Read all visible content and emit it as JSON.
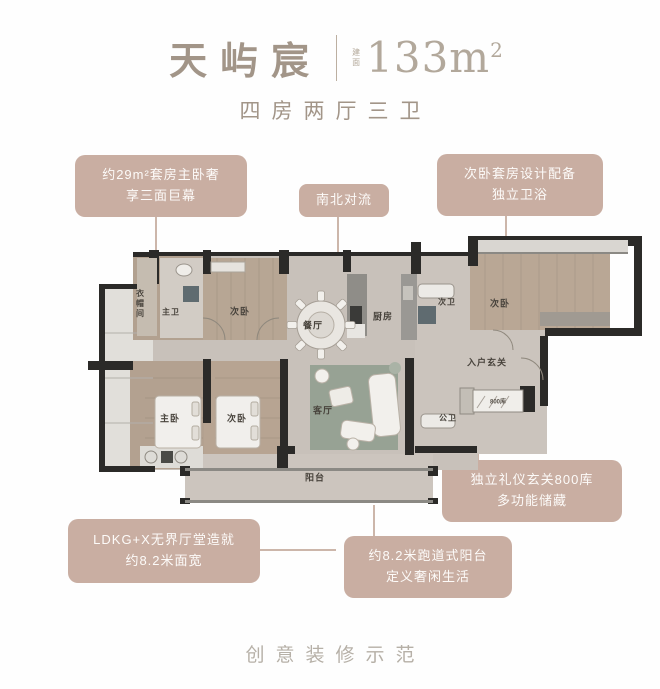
{
  "header": {
    "title": "天屿宸",
    "area_label": "建面",
    "area_value": "133m",
    "area_sup": "2",
    "subtitle": "四房两厅三卫"
  },
  "callouts": {
    "master_suite": {
      "line1": "约29m²套房主卧奢",
      "line2": "享三面巨幕"
    },
    "airflow": {
      "line1": "南北对流"
    },
    "second_suite": {
      "line1": "次卧套房设计配备",
      "line2": "独立卫浴"
    },
    "ldkg": {
      "line1": "LDKG+X无界厅堂造就",
      "line2": "约8.2米面宽"
    },
    "runway_balcony": {
      "line1": "约8.2米跑道式阳台",
      "line2": "定义奢闲生活"
    },
    "foyer_storage": {
      "line1": "独立礼仪玄关800库",
      "line2": "多功能储藏"
    }
  },
  "plan_labels": {
    "cloakroom": "衣帽间",
    "master_bath": "主卫",
    "bedroom_top": "次卧",
    "dining": "餐厅",
    "kitchen": "厨房",
    "bath_second": "次卫",
    "bedroom_right": "次卧",
    "entry_foyer": "入户玄关",
    "master_bedroom": "主卧",
    "bedroom_mid": "次卧",
    "living": "客厅",
    "bath_public": "公卫",
    "balcony": "阳台",
    "cabinet": "800库"
  },
  "footer": {
    "caption": "创意装修示范"
  },
  "colors": {
    "callout_bg": "#c9aea2",
    "title_text": "#a29588",
    "wall": "#2b2a28",
    "wood_floor": "#b4a292",
    "marble_floor": "#c8c1ba",
    "rug_green": "#97a294"
  }
}
